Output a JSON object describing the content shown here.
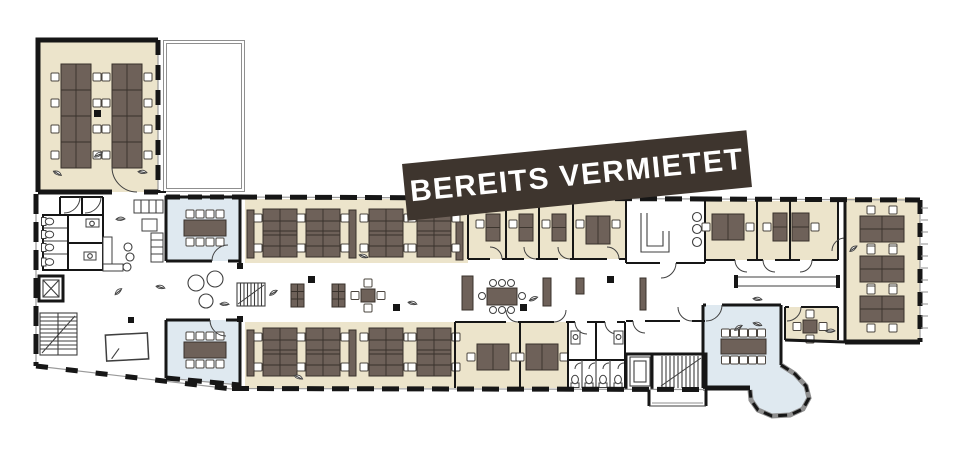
{
  "banner": {
    "label": "BEREITS VERMIETET"
  },
  "palette": {
    "bg": "#ffffff",
    "office": "#ece4cb",
    "meeting": "#dfe9f0",
    "desk": "#6e6159",
    "desk_line": "#38312b",
    "wall": "#161616",
    "line": "#3f3f3f",
    "light_line": "#8f8f8f",
    "chair": "#ffffff",
    "banner_bg": "#3e352e",
    "banner_fg": "#ffffff"
  },
  "icons": {
    "plant": "leaf-sprig",
    "toilet": "wc-toilet",
    "stairs": "stair-run-with-diagonal",
    "elevator": "crossed-box",
    "door": "quarter-arc"
  },
  "plan": {
    "type": "floor-plan",
    "language": "de",
    "status_label": "BEREITS VERMIETET",
    "zones": [
      {
        "name": "open-office-northwest",
        "kind": "open-office",
        "desk_banks": 2,
        "desks": 16,
        "fill": "office"
      },
      {
        "name": "terrace-north",
        "kind": "terrace"
      },
      {
        "name": "lobby-west",
        "kind": "lobby",
        "lounge_tables": 3
      },
      {
        "name": "wc-west",
        "kind": "wc",
        "toilets": 4
      },
      {
        "name": "elevator-west",
        "kind": "elevator"
      },
      {
        "name": "stairs-west",
        "kind": "stairs"
      },
      {
        "name": "meeting-room-west-north",
        "kind": "meeting",
        "seats": 8,
        "fill": "meeting"
      },
      {
        "name": "meeting-room-west-south",
        "kind": "meeting",
        "seats": 8,
        "fill": "meeting"
      },
      {
        "name": "open-office-north-band",
        "kind": "open-office",
        "desk_clusters": 4,
        "fill": "office"
      },
      {
        "name": "offices-north",
        "kind": "office-row",
        "rooms": 4,
        "fill": "office"
      },
      {
        "name": "kitchen",
        "kind": "kitchen",
        "stools": 3
      },
      {
        "name": "corridor-central",
        "kind": "corridor",
        "stairs": 1,
        "meeting_tables": 2
      },
      {
        "name": "open-office-south-band",
        "kind": "open-office",
        "desk_clusters": 4,
        "fill": "office"
      },
      {
        "name": "offices-south",
        "kind": "office-row",
        "rooms": 2,
        "fill": "office"
      },
      {
        "name": "wc-south",
        "kind": "wc",
        "toilets": 4
      },
      {
        "name": "stairs-south",
        "kind": "stairs"
      },
      {
        "name": "elevator-south",
        "kind": "elevator"
      },
      {
        "name": "entrance-stoop-south",
        "kind": "entrance"
      },
      {
        "name": "offices-east",
        "kind": "office-row",
        "rooms": 3,
        "fill": "office"
      },
      {
        "name": "lobby-east",
        "kind": "lobby"
      },
      {
        "name": "open-office-east",
        "kind": "open-office",
        "desk_clusters": 3,
        "fill": "office"
      },
      {
        "name": "meeting-room-bay",
        "kind": "meeting",
        "seats": 10,
        "fill": "meeting"
      },
      {
        "name": "meeting-room-east-small",
        "kind": "meeting",
        "seats": 4,
        "fill": "office"
      }
    ]
  }
}
